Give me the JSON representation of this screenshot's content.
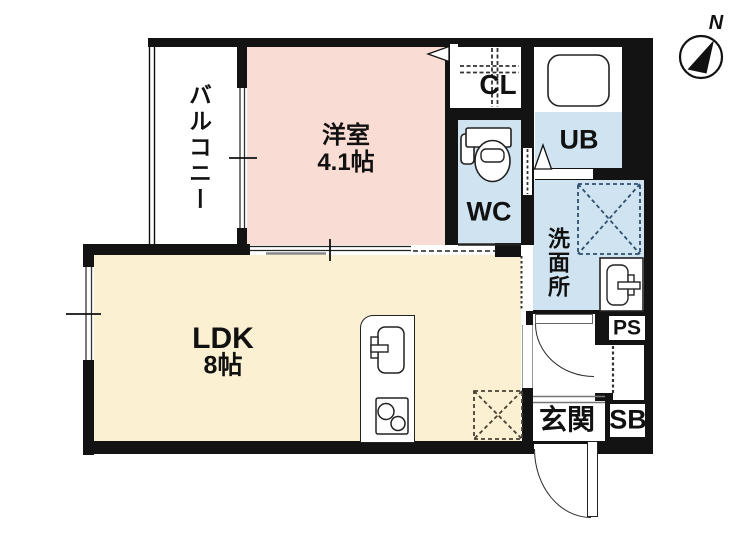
{
  "floorplan": {
    "compass": {
      "north_label": "N"
    },
    "rooms": {
      "balcony": {
        "label": "バルコニー"
      },
      "western_room": {
        "label": "洋室",
        "size": "4.1帖"
      },
      "ldk": {
        "label": "LDK",
        "size": "8帖"
      },
      "closet": {
        "label": "CL"
      },
      "toilet": {
        "label": "WC"
      },
      "unit_bath": {
        "label": "UB"
      },
      "washroom": {
        "label": "洗面所"
      },
      "pipe_space": {
        "label": "PS"
      },
      "entrance": {
        "label": "玄関"
      },
      "shoe_box": {
        "label": "SB"
      }
    },
    "colors": {
      "wall": "#131313",
      "western_room_fill": "#f9dcd3",
      "ldk_fill": "#fcf0d2",
      "wet_area_fill": "#cfe3f1"
    }
  }
}
